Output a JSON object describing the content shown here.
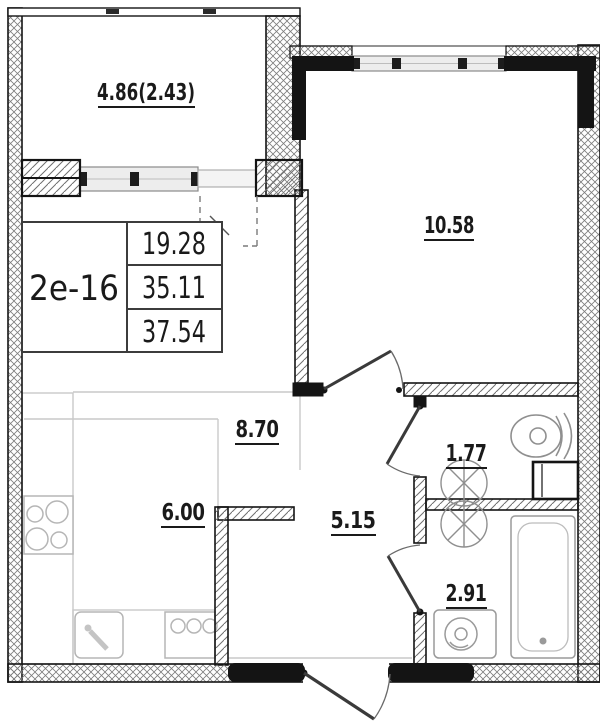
{
  "plan": {
    "unit": "2е-16",
    "area_table": {
      "living": "19.28",
      "apartment": "35.11",
      "total": "37.54"
    },
    "rooms": {
      "balcony": "4.86(2.43)",
      "room": "10.58",
      "living_zone": "8.70",
      "kitchen_zone": "6.00",
      "hall": "5.15",
      "wc": "1.77",
      "bathroom": "2.91"
    },
    "fixtures": [
      "stove-4-burner",
      "kitchen-sink",
      "kitchen-appliance",
      "toilet",
      "water-heater",
      "washbasin-wc",
      "washbasin-bathroom",
      "washing-machine",
      "bathtub"
    ],
    "colors": {
      "wall_line": "#141414",
      "hatch": "#7d7d7d",
      "fixture_line": "#9a9a9a",
      "light_line": "#c9c9c9",
      "window_fill": "#ededed",
      "background": "#ffffff"
    }
  }
}
